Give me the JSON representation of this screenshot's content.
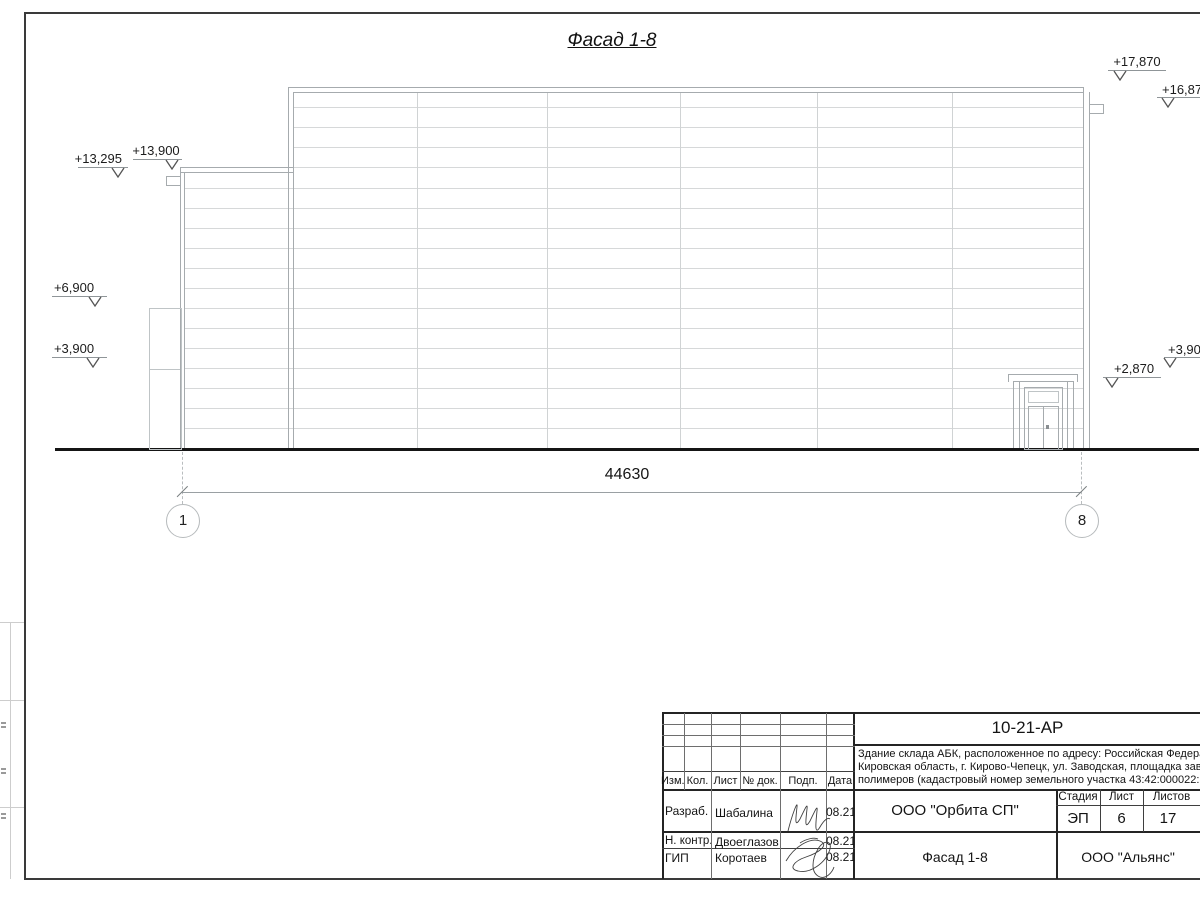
{
  "drawing": {
    "view_title": "Фасад 1-8",
    "overall_dimension": "44630",
    "axis_marks": [
      "1",
      "8"
    ],
    "elevations": {
      "left_parapet_low": "+13,295",
      "left_parapet": "+13,900",
      "roof_top": "+17,870",
      "roof_edge": "+16,870",
      "mid_left": "+6,900",
      "low_left": "+3,900",
      "door_top": "+2,870",
      "low_right": "+3,900"
    }
  },
  "titleblock": {
    "doc_number": "10-21-АР",
    "description_line1": "Здание склада АБК, расположенное по адресу: Российская Федерация,",
    "description_line2": "Кировская область, г. Кирово-Чепецк, ул. Заводская, площадка завода",
    "description_line3": "полимеров (кадастровый номер земельного участка 43:42:000022:3",
    "header": {
      "izm": "Изм.",
      "kol": "Кол.",
      "list": "Лист",
      "doc": "№ док.",
      "podp": "Подп.",
      "data": "Дата"
    },
    "rows": [
      {
        "role": "Разраб.",
        "name": "Шабалина",
        "date": "08.21"
      },
      {
        "role": "Н. контр.",
        "name": "Двоеглазов",
        "date": "08.21"
      },
      {
        "role": "ГИП",
        "name": "Коротаев",
        "date": "08.21"
      }
    ],
    "stage_label": "Стадия",
    "sheet_label": "Лист",
    "sheets_label": "Листов",
    "stage": "ЭП",
    "sheet_no": "6",
    "sheets_total": "17",
    "org": "ООО \"Орбита СП\"",
    "view_name": "Фасад 1-8",
    "customer": "ООО \"Альянс\""
  }
}
